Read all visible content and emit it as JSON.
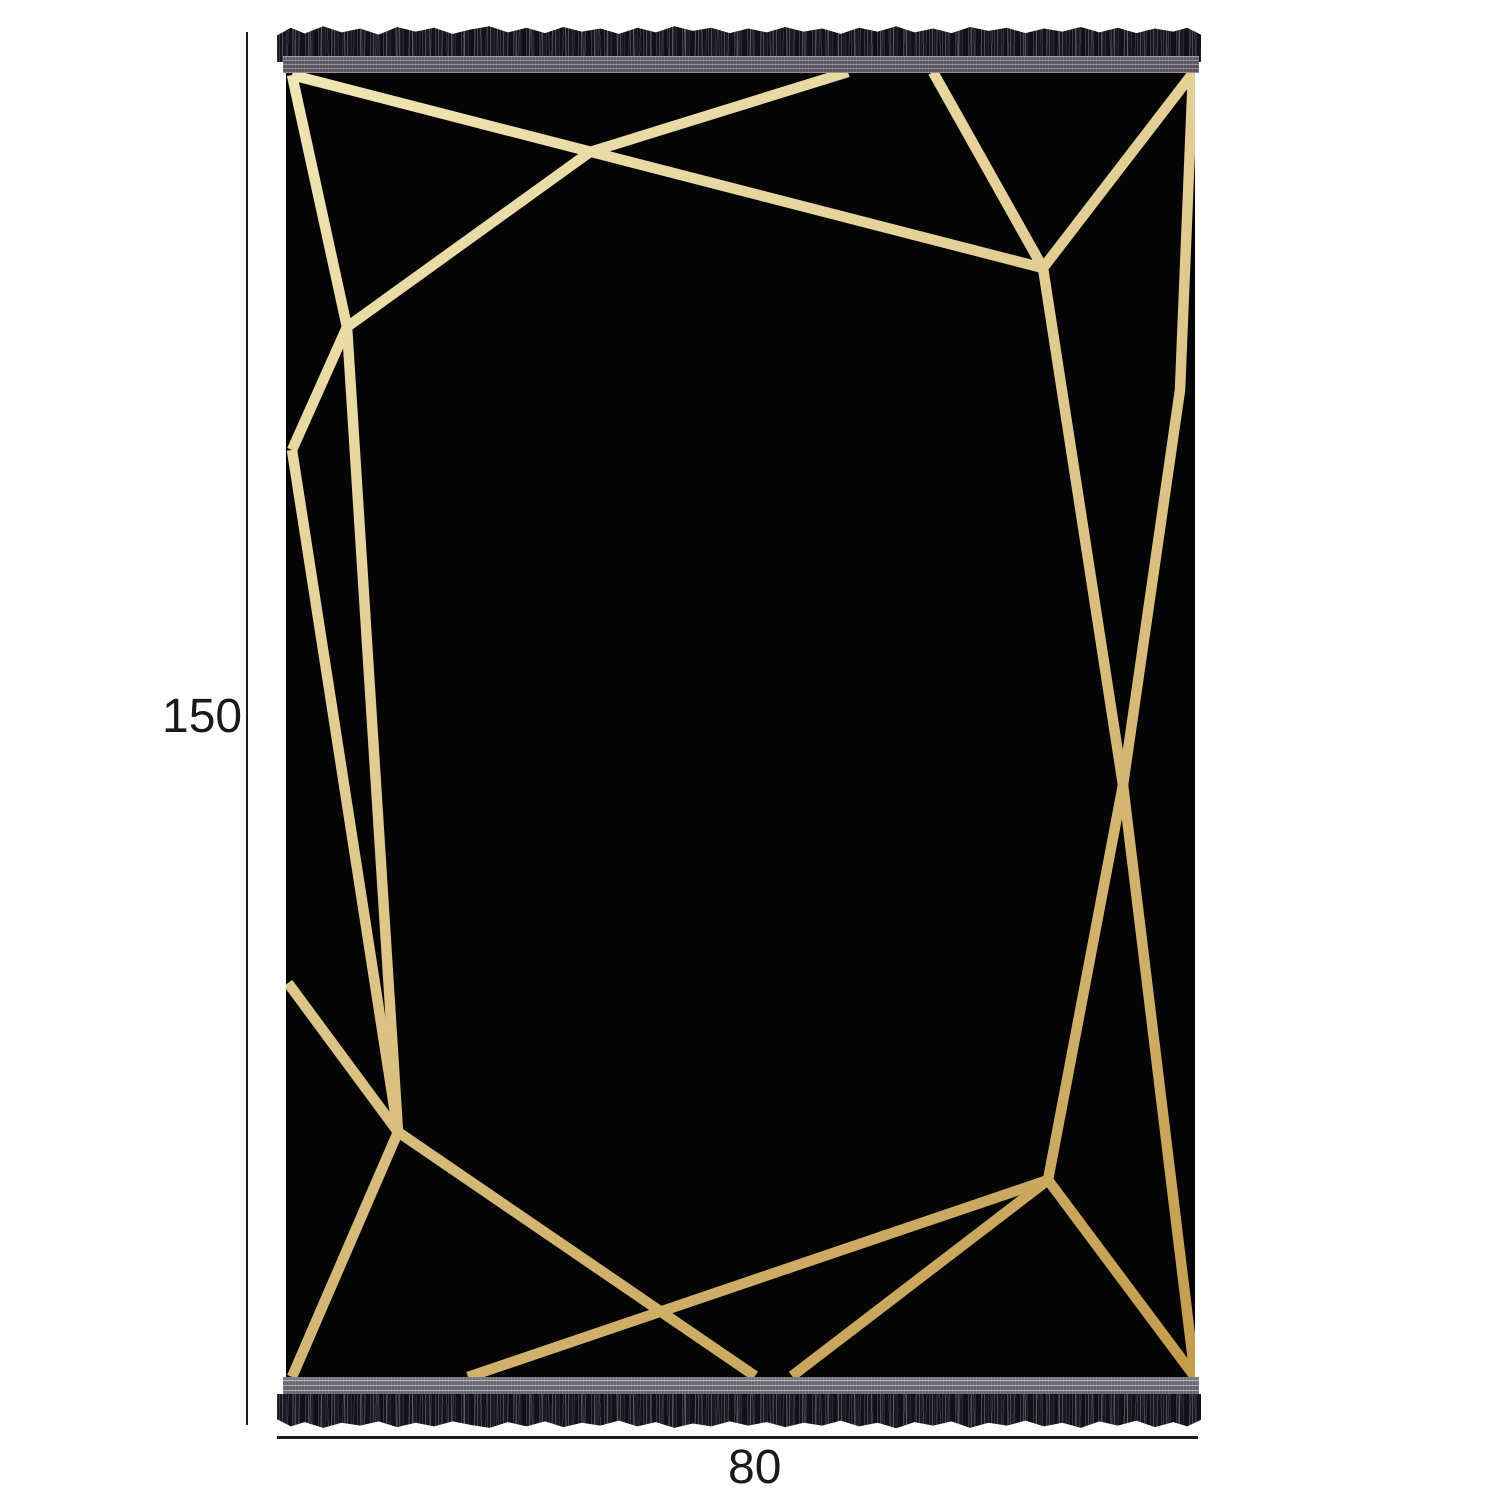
{
  "canvas": {
    "background": "#ffffff"
  },
  "annotations": {
    "height_label": "150",
    "width_label": "80",
    "line_color": "#1c1c1c",
    "text_color": "#1a1a1a"
  },
  "rug": {
    "fabric_color": "#050505",
    "stroke_width": 10.5,
    "gold_gradient": [
      "#f0e6b4",
      "#ddc487",
      "#c39b4c"
    ],
    "pattern_segments": [
      [
        [
          292,
          75
        ],
        [
          1043,
          268
        ]
      ],
      [
        [
          848,
          72
        ],
        [
          590,
          152
        ],
        [
          347,
          327
        ]
      ],
      [
        [
          292,
          75
        ],
        [
          347,
          327
        ]
      ],
      [
        [
          347,
          327
        ],
        [
          292,
          450
        ]
      ],
      [
        [
          292,
          450
        ],
        [
          398,
          1132
        ]
      ],
      [
        [
          347,
          327
        ],
        [
          398,
          1132
        ]
      ],
      [
        [
          288,
          983
        ],
        [
          398,
          1132
        ]
      ],
      [
        [
          398,
          1132
        ],
        [
          292,
          1377
        ]
      ],
      [
        [
          398,
          1132
        ],
        [
          755,
          1376
        ]
      ],
      [
        [
          933,
          72
        ],
        [
          1043,
          268
        ]
      ],
      [
        [
          1193,
          73
        ],
        [
          1043,
          268
        ]
      ],
      [
        [
          1043,
          268
        ],
        [
          1123,
          785
        ],
        [
          1195,
          1377
        ]
      ],
      [
        [
          1193,
          73
        ],
        [
          1180,
          390
        ],
        [
          1123,
          785
        ],
        [
          1048,
          1180
        ]
      ],
      [
        [
          1048,
          1180
        ],
        [
          1195,
          1377
        ]
      ],
      [
        [
          1048,
          1180
        ],
        [
          792,
          1376
        ]
      ],
      [
        [
          1048,
          1180
        ],
        [
          468,
          1377
        ]
      ]
    ],
    "fringe": {
      "strand_dark": "#111118",
      "strand_mid": "#34323d",
      "strand_light": "#5e5b69",
      "band_top_color": "#57545e",
      "band_bottom_color": "#6d6a76",
      "stitch_light": "#a9a7b2",
      "stitch_red": "#6a5a5e"
    }
  }
}
